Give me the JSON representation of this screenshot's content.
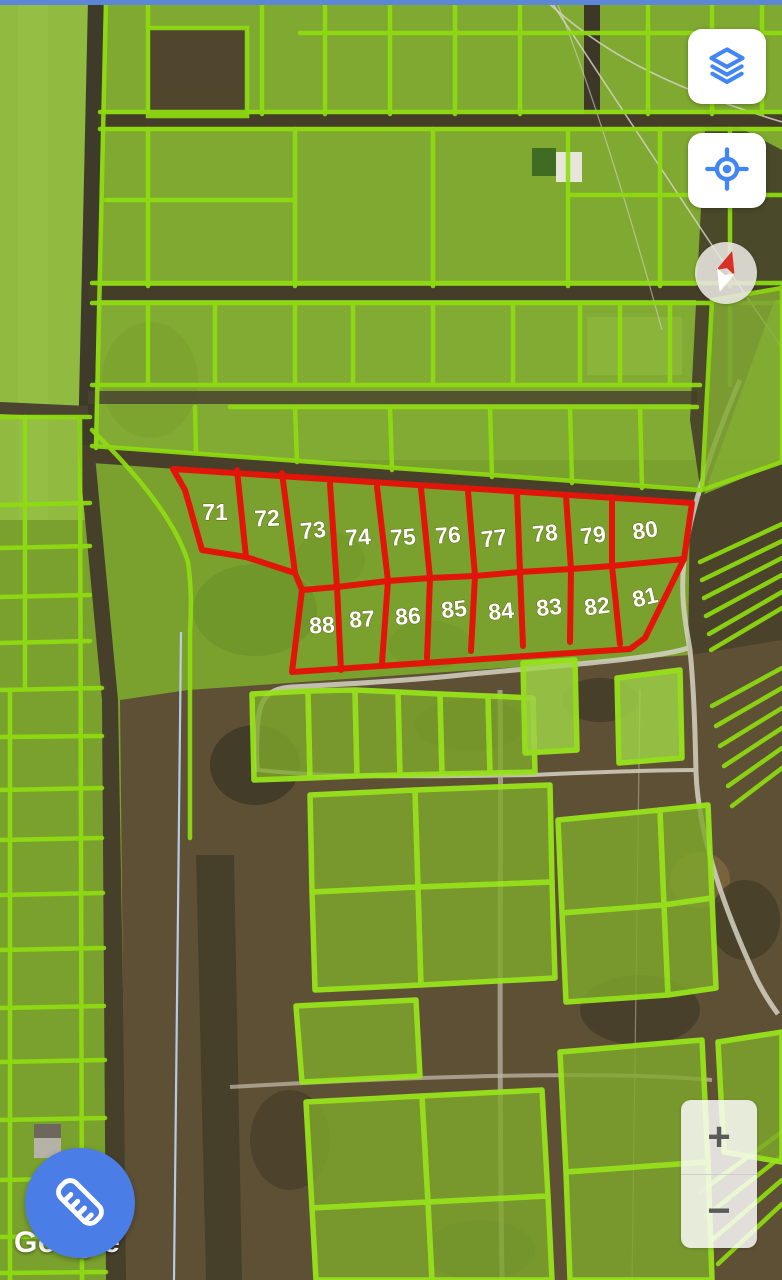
{
  "status_bar": {
    "color": "#5b87d6"
  },
  "map": {
    "watermark": "Google",
    "overlay": {
      "stroke_color": "#e2150a",
      "label_color": "#ffffff",
      "outer": [
        [
          173,
          469
        ],
        [
          692,
          503
        ],
        [
          684,
          559
        ],
        [
          645,
          638
        ],
        [
          630,
          649
        ],
        [
          292,
          672
        ],
        [
          302,
          590
        ],
        [
          295,
          573
        ],
        [
          246,
          557
        ],
        [
          202,
          550
        ],
        [
          185,
          490
        ]
      ],
      "midline": [
        [
          302,
          590
        ],
        [
          337,
          587
        ],
        [
          388,
          581
        ],
        [
          430,
          578
        ],
        [
          475,
          576
        ],
        [
          520,
          572
        ],
        [
          571,
          569
        ],
        [
          612,
          566
        ],
        [
          684,
          559
        ]
      ],
      "dividers": [
        [
          [
            237,
            470
          ],
          [
            246,
            557
          ]
        ],
        [
          [
            282,
            473
          ],
          [
            295,
            573
          ]
        ],
        [
          [
            330,
            484
          ],
          [
            337,
            587
          ],
          [
            341,
            670
          ]
        ],
        [
          [
            377,
            487
          ],
          [
            388,
            581
          ],
          [
            382,
            663
          ]
        ],
        [
          [
            421,
            488
          ],
          [
            430,
            578
          ],
          [
            427,
            658
          ]
        ],
        [
          [
            468,
            491
          ],
          [
            475,
            576
          ],
          [
            471,
            651
          ]
        ],
        [
          [
            517,
            493
          ],
          [
            520,
            572
          ],
          [
            523,
            646
          ]
        ],
        [
          [
            566,
            496
          ],
          [
            571,
            569
          ],
          [
            570,
            642
          ]
        ],
        [
          [
            612,
            497
          ],
          [
            612,
            566
          ],
          [
            620,
            644
          ]
        ]
      ],
      "parcels": [
        {
          "number": "71",
          "x": 215,
          "y": 512,
          "rot": 0
        },
        {
          "number": "72",
          "x": 267,
          "y": 518,
          "rot": -2
        },
        {
          "number": "73",
          "x": 313,
          "y": 530,
          "rot": -6
        },
        {
          "number": "74",
          "x": 358,
          "y": 537,
          "rot": -4
        },
        {
          "number": "75",
          "x": 403,
          "y": 537,
          "rot": -4
        },
        {
          "number": "76",
          "x": 448,
          "y": 535,
          "rot": -4
        },
        {
          "number": "77",
          "x": 494,
          "y": 538,
          "rot": -7
        },
        {
          "number": "78",
          "x": 545,
          "y": 533,
          "rot": -5
        },
        {
          "number": "79",
          "x": 593,
          "y": 535,
          "rot": -7
        },
        {
          "number": "80",
          "x": 645,
          "y": 530,
          "rot": -8
        },
        {
          "number": "81",
          "x": 645,
          "y": 597,
          "rot": -13
        },
        {
          "number": "82",
          "x": 597,
          "y": 606,
          "rot": -7
        },
        {
          "number": "83",
          "x": 549,
          "y": 607,
          "rot": -6
        },
        {
          "number": "84",
          "x": 501,
          "y": 611,
          "rot": -5
        },
        {
          "number": "85",
          "x": 454,
          "y": 609,
          "rot": -6
        },
        {
          "number": "86",
          "x": 408,
          "y": 616,
          "rot": -4
        },
        {
          "number": "87",
          "x": 362,
          "y": 619,
          "rot": -4
        },
        {
          "number": "88",
          "x": 322,
          "y": 625,
          "rot": -3
        }
      ]
    }
  },
  "controls": {
    "layers_button": {
      "icon": "layers-icon"
    },
    "my_location_button": {
      "icon": "my-location-icon"
    },
    "compass": {
      "icon": "compass-needle-icon"
    },
    "zoom_in_label": "+",
    "zoom_out_label": "−",
    "measure_button": {
      "icon": "ruler-icon"
    }
  }
}
